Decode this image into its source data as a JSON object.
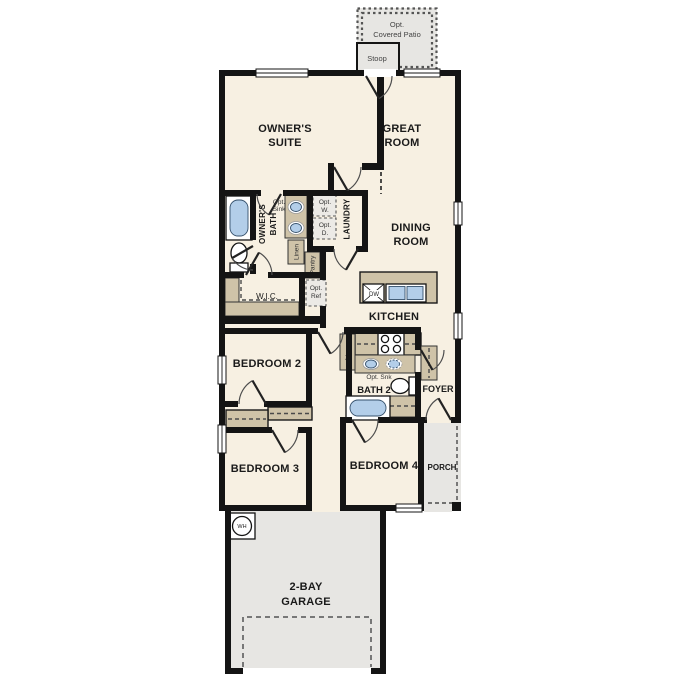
{
  "title": "Single-story house floor plan",
  "colors": {
    "floor": "#f7f0e2",
    "outdoor_concrete": "#e7e6e3",
    "cabinet_tan": "#cfc3a8",
    "fixture_blue": "#b3cee9",
    "wall_black": "#141414"
  },
  "labels": {
    "patio_1": "Opt.",
    "patio_2": "Covered Patio",
    "stoop": "Stoop",
    "owners_suite_1": "OWNER'S",
    "owners_suite_2": "SUITE",
    "great_room_1": "GREAT",
    "great_room_2": "ROOM",
    "dining_1": "DINING",
    "dining_2": "ROOM",
    "kitchen": "KITCHEN",
    "owners_bath_1": "OWNER'S",
    "owners_bath_2": "BATH",
    "opt_sink_1": "Opt.",
    "opt_sink_2": "Sink",
    "laundry": "LAUNDRY",
    "opt_w_1": "Opt.",
    "opt_w_2": "W.",
    "opt_d_1": "Opt.",
    "opt_d_2": "D.",
    "linen_hall": "Linen",
    "pantry": "Pantry",
    "wic": "W.I.C.",
    "opt_ref_1": "Opt.",
    "opt_ref_2": "Ref",
    "bedroom2": "BEDROOM 2",
    "bedroom3": "BEDROOM 3",
    "bedroom4": "BEDROOM 4",
    "linen_bath2": "Linen",
    "opt_snk": "Opt. Snk",
    "bath2": "BATH 2",
    "foyer": "FOYER",
    "porch": "PORCH",
    "wh": "WH",
    "dw": "DW",
    "garage_1": "2-BAY",
    "garage_2": "GARAGE"
  }
}
